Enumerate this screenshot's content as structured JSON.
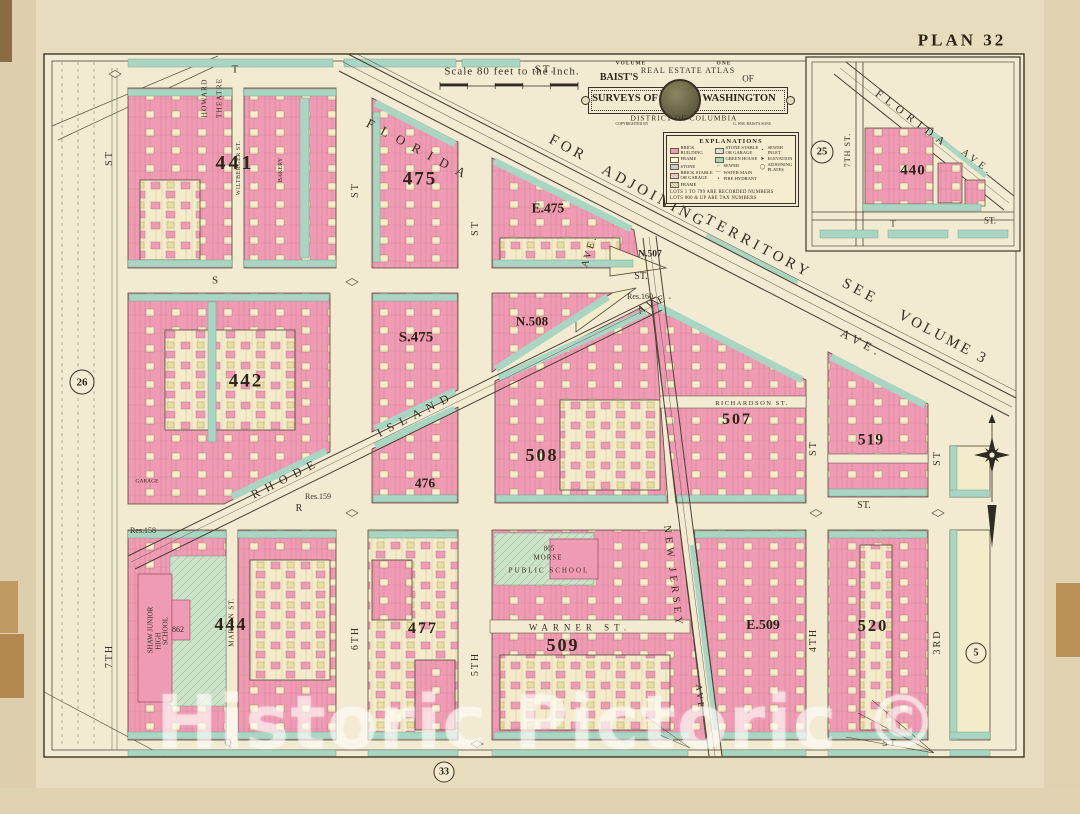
{
  "page": {
    "plan_label": "PLAN 32",
    "scale_text": "Scale 80 feet to the Inch.",
    "watermark": "Historic Pictoric ©"
  },
  "cartouche": {
    "volume": "VOLUME",
    "one": "ONE",
    "baists": "BAIST'S",
    "atlas": "REAL ESTATE ATLAS",
    "of": "OF",
    "surveys": "SURVEYS OF",
    "washington": "WASHINGTON",
    "district": "DISTRICT OF COLUMBIA",
    "copyright_left": "COPYRIGHTED BY",
    "copyright_right": "G. WM. BAIST'S SONS"
  },
  "legend": {
    "title": "EXPLANATIONS",
    "col1": [
      {
        "label": "BRICK BUILDING"
      },
      {
        "label": "FRAME"
      },
      {
        "label": "STONE"
      },
      {
        "label": "BRICK STABLE OR GARAGE"
      },
      {
        "label": "FRAME"
      }
    ],
    "col2": [
      {
        "label": "STONE STABLE OR GARAGE",
        "symbol": ""
      },
      {
        "label": "GREEN HOUSE",
        "symbol": ""
      },
      {
        "label": "SEWER",
        "symbol": "⌐"
      },
      {
        "label": "WATER MAIN",
        "symbol": "―"
      },
      {
        "label": "FIRE HYDRANT",
        "symbol": "•"
      }
    ],
    "col3": [
      {
        "label": "SEWER INLET",
        "symbol": "▪"
      },
      {
        "label": "ELEVATION",
        "symbol": "➤"
      },
      {
        "label": "ADJOINING PLATES",
        "symbol": "◯"
      }
    ],
    "notes": [
      "LOTS 1 TO 799 ARE RECORDED NUMBERS",
      "LOTS 800 & UP ARE TAX NUMBERS"
    ]
  },
  "adjoining": {
    "w1": "FOR",
    "w2": "ADJOINING",
    "w3": "TERRITORY",
    "w4": "SEE",
    "w5": "VOLUME 3"
  },
  "streets": {
    "t": "T",
    "st": "ST.",
    "st2": "ST",
    "s": "S",
    "r": "R",
    "q": "Q",
    "seventh": "7TH",
    "sixth": "6TH",
    "fifth": "5TH",
    "fourth": "4TH",
    "third": "3RD",
    "marion": "MARION ST.",
    "wiltberger": "WILTBERGER ST.",
    "warner": "WARNER ST.",
    "richardson": "RICHARDSON ST.",
    "florida": "FLORIDA",
    "ave": "AVE.",
    "rhode": "RHODE",
    "island": "ISLAND",
    "new_jersey": "NEW JERSEY"
  },
  "blocks": {
    "b441": "441",
    "b475": "475",
    "e475": "E.475",
    "b442": "442",
    "s475": "S.475",
    "n508": "N.508",
    "b508": "508",
    "b476": "476",
    "n507": "N.507",
    "b507": "507",
    "b519": "519",
    "b444": "444",
    "b477": "477",
    "b509": "509",
    "e509": "E.509",
    "b520": "520",
    "b440": "440",
    "res158": "Res.158",
    "res159": "Res.159",
    "res160": "Res.160",
    "lot862": "862"
  },
  "pois": {
    "howard": "HOWARD",
    "theatre": "THEATRE",
    "bakery": "BAKERY",
    "garage": "GARAGE",
    "shaw1": "SHAW JUNIOR",
    "shaw2": "HIGH",
    "shaw3": "SCHOOL",
    "ps_no": "805",
    "ps_name": "MORSE",
    "ps": "PUBLIC SCHOOL"
  },
  "plates": {
    "p26": "26",
    "p25": "25",
    "p5": "5",
    "p33": "33"
  },
  "inset": {
    "florida": "FLORIDA",
    "ave": "AVE.",
    "seventh": "7TH ST.",
    "t": "T",
    "st": "ST."
  }
}
